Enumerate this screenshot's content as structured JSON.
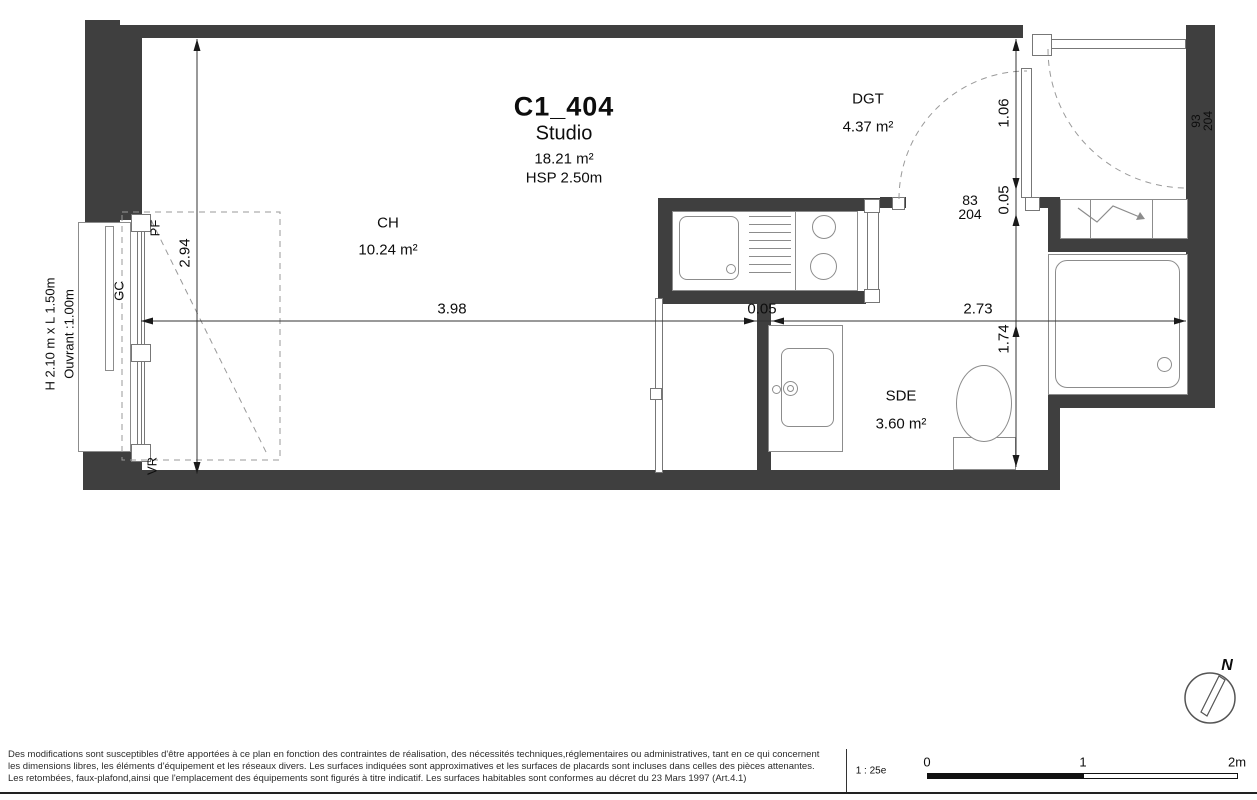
{
  "plan": {
    "title": {
      "code": "C1_404",
      "type": "Studio",
      "area": "18.21 m²",
      "hsp": "HSP 2.50m"
    },
    "rooms": {
      "ch": {
        "name": "CH",
        "area": "10.24 m²"
      },
      "dgt": {
        "name": "DGT",
        "area": "4.37 m²"
      },
      "sde": {
        "name": "SDE",
        "area": "3.60 m²"
      }
    },
    "dims": {
      "w_ch": "3.98",
      "w_partition": "0.05",
      "w_sde": "2.73",
      "h_ch": "2.94",
      "h_dgt": "1.06",
      "h_wall": "0.05",
      "h_sde": "1.74"
    },
    "doors": {
      "interior": {
        "width": "83",
        "height": "204"
      },
      "entry": {
        "width": "93",
        "height": "204"
      }
    },
    "window": {
      "size": "H 2.10 m x L 1.50m",
      "opening": "Ouvrant :1.00m",
      "gc": "GC",
      "pf": "PF",
      "vr": "VR"
    }
  },
  "footer": {
    "disclaimer": [
      "Des modifications sont susceptibles d'être apportées à ce plan en fonction des contraintes de réalisation, des nécessités techniques,réglementaires ou administratives, tant en ce qui concernent",
      "les dimensions libres, les éléments d'équipement et les réseaux divers. Les surfaces indiquées sont approximatives et les surfaces de placards sont incluses dans celles des pièces attenantes.",
      "Les retombées, faux-plafond,ainsi que l'emplacement des équipements sont figurés à titre indicatif. Les surfaces habitables sont conformes au décret du 23 Mars 1997 (Art.4.1)"
    ],
    "scale": {
      "label": "1 : 25e",
      "ticks": [
        "0",
        "1",
        "2m"
      ]
    }
  },
  "compass": {
    "label": "N"
  },
  "colors": {
    "wall": "#3f3f3f",
    "line": "#333333",
    "fixture": "#8c8c8c",
    "dash": "#9a9a9a"
  }
}
